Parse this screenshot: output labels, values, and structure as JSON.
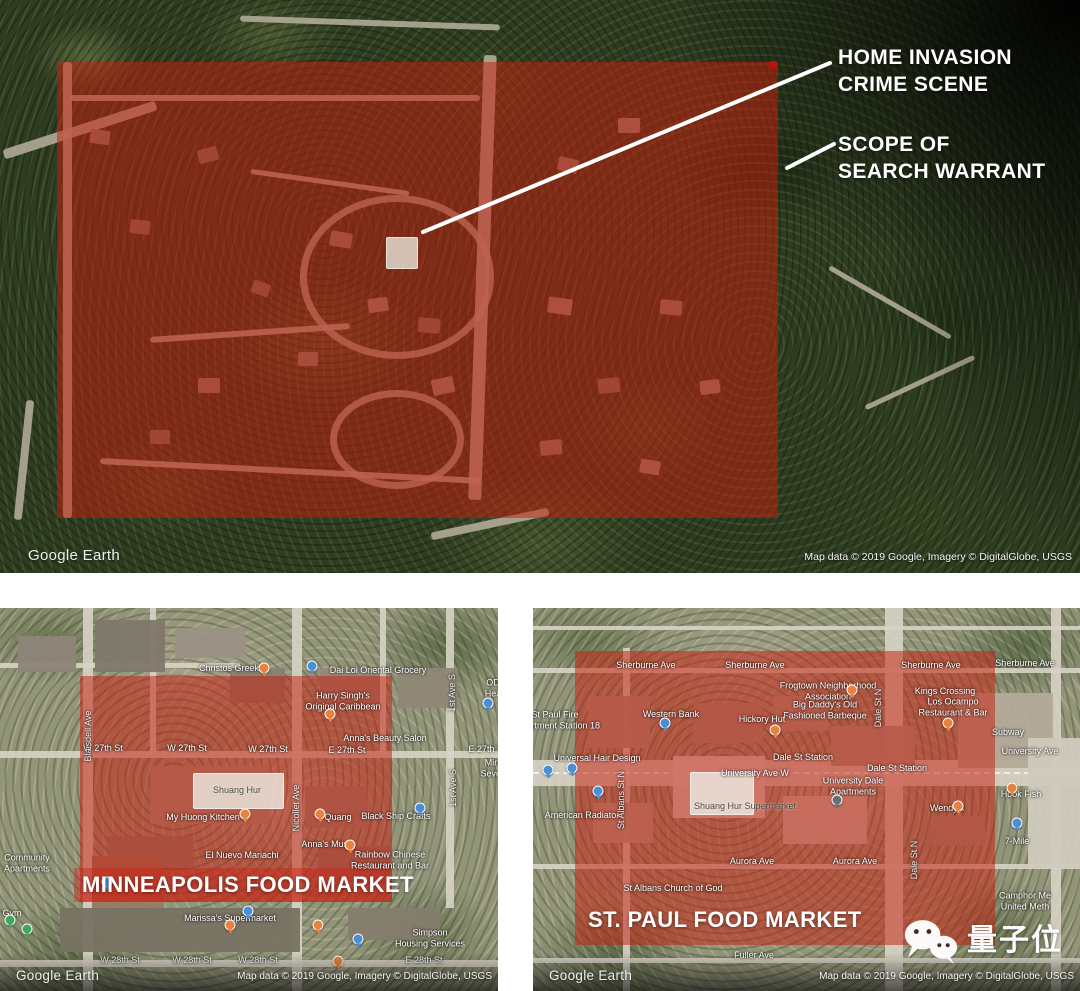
{
  "colors": {
    "overlay_red": "#c71e10",
    "callout_text": "#ffffff",
    "highlight_box": "#eeece4"
  },
  "top_map": {
    "callout1": "HOME INVASION\nCRIME SCENE",
    "callout2": "SCOPE OF\nSEARCH WARRANT",
    "logo": "Google Earth",
    "attribution": "Map data © 2019 Google, Imagery © DigitalGlobe, USGS"
  },
  "minneapolis_map": {
    "title": "MINNEAPOLIS FOOD MARKET",
    "logo": "Google Earth",
    "attribution": "Map data © 2019 Google, Imagery © DigitalGlobe, USGS",
    "highlight_label": "Shuang Hur",
    "labels": [
      {
        "t": "Christos Greek",
        "x": 229,
        "y": 60
      },
      {
        "t": "Dai Loi Oriental Grocery",
        "x": 378,
        "y": 62
      },
      {
        "t": "OD\nHea",
        "x": 493,
        "y": 80
      },
      {
        "t": "Harry Singh's\nOriginal Caribbean",
        "x": 343,
        "y": 93
      },
      {
        "t": "Anna's Beauty Salon",
        "x": 385,
        "y": 130
      },
      {
        "t": "W 27th St",
        "x": 103,
        "y": 140
      },
      {
        "t": "W 27th St",
        "x": 187,
        "y": 140
      },
      {
        "t": "W 27th St",
        "x": 268,
        "y": 141
      },
      {
        "t": "E 27th St",
        "x": 347,
        "y": 142
      },
      {
        "t": "E 27th St",
        "x": 487,
        "y": 141
      },
      {
        "t": "Minne\nSeventh",
        "x": 497,
        "y": 160
      },
      {
        "t": "Blaisdell Ave",
        "x": 88,
        "y": 128,
        "v": 1
      },
      {
        "t": "Nicollet Ave",
        "x": 296,
        "y": 200,
        "v": 1
      },
      {
        "t": "1st Ave S",
        "x": 452,
        "y": 85,
        "v": 1
      },
      {
        "t": "1st Ave S",
        "x": 453,
        "y": 180,
        "v": 1
      },
      {
        "t": "My Huong Kitchen",
        "x": 203,
        "y": 209
      },
      {
        "t": "Quang",
        "x": 338,
        "y": 209
      },
      {
        "t": "Black Ship Crafts",
        "x": 396,
        "y": 208
      },
      {
        "t": "Anna's Music",
        "x": 328,
        "y": 236
      },
      {
        "t": "El Nuevo Mariachi",
        "x": 242,
        "y": 247
      },
      {
        "t": "Rainbow Chinese\nRestaurant and Bar",
        "x": 390,
        "y": 252
      },
      {
        "t": "Community\nApartments",
        "x": 27,
        "y": 255
      },
      {
        "t": "Gym",
        "x": 12,
        "y": 305
      },
      {
        "t": "Marissa's Supermarket",
        "x": 230,
        "y": 310
      },
      {
        "t": "Simpson\nHousing Services",
        "x": 430,
        "y": 330
      },
      {
        "t": "W 28th St",
        "x": 120,
        "y": 352
      },
      {
        "t": "W 28th St",
        "x": 192,
        "y": 352
      },
      {
        "t": "W 28th St",
        "x": 258,
        "y": 352
      },
      {
        "t": "E 28th St",
        "x": 424,
        "y": 352
      }
    ],
    "pins": [
      {
        "x": 264,
        "y": 60,
        "c": "o"
      },
      {
        "x": 330,
        "y": 106,
        "c": "o"
      },
      {
        "x": 245,
        "y": 206,
        "c": "o"
      },
      {
        "x": 320,
        "y": 206,
        "c": "o"
      },
      {
        "x": 350,
        "y": 237,
        "c": "o"
      },
      {
        "x": 230,
        "y": 317,
        "c": "o"
      },
      {
        "x": 318,
        "y": 317,
        "c": "o"
      },
      {
        "x": 338,
        "y": 353,
        "c": "o"
      },
      {
        "x": 312,
        "y": 58,
        "c": "b"
      },
      {
        "x": 420,
        "y": 200,
        "c": "b"
      },
      {
        "x": 358,
        "y": 331,
        "c": "b"
      },
      {
        "x": 107,
        "y": 274,
        "c": "b"
      },
      {
        "x": 488,
        "y": 95,
        "c": "b"
      },
      {
        "x": 248,
        "y": 303,
        "c": "b"
      },
      {
        "x": 10,
        "y": 312,
        "c": "g"
      },
      {
        "x": 27,
        "y": 321,
        "c": "g"
      }
    ]
  },
  "stpaul_map": {
    "title": "ST. PAUL FOOD MARKET",
    "logo": "Google Earth",
    "attribution": "Map data © 2019 Google, Imagery © DigitalGlobe, USGS",
    "highlight_label": "Shuang Hur Supermarket",
    "labels": [
      {
        "t": "Sherburne Ave",
        "x": 113,
        "y": 57
      },
      {
        "t": "Sherburne Ave",
        "x": 222,
        "y": 57
      },
      {
        "t": "Sherburne Ave",
        "x": 398,
        "y": 57
      },
      {
        "t": "Sherburne Ave",
        "x": 492,
        "y": 55
      },
      {
        "t": "Frogtown Neighborhood\nAssociation",
        "x": 295,
        "y": 83
      },
      {
        "t": "Big Daddy's Old\nFashioned Barbeque",
        "x": 292,
        "y": 102
      },
      {
        "t": "Kings Crossing",
        "x": 412,
        "y": 83
      },
      {
        "t": "Los Ocampo\nRestaurant & Bar",
        "x": 420,
        "y": 99
      },
      {
        "t": "St Paul Fire\nDepartment Station 18",
        "x": 22,
        "y": 112
      },
      {
        "t": "Western Bank",
        "x": 138,
        "y": 106
      },
      {
        "t": "Hickory Hut",
        "x": 229,
        "y": 111
      },
      {
        "t": "Subway",
        "x": 475,
        "y": 124
      },
      {
        "t": "Universal Hair Design",
        "x": 64,
        "y": 150
      },
      {
        "t": "Dale St Station",
        "x": 270,
        "y": 149
      },
      {
        "t": "Dale St Station",
        "x": 364,
        "y": 160
      },
      {
        "t": "University Ave W",
        "x": 222,
        "y": 165
      },
      {
        "t": "University Ave",
        "x": 497,
        "y": 143
      },
      {
        "t": "University Dale\nApartments",
        "x": 320,
        "y": 178
      },
      {
        "t": "American Radiator",
        "x": 49,
        "y": 207
      },
      {
        "t": "Wendy's",
        "x": 414,
        "y": 200
      },
      {
        "t": "Hook Fish",
        "x": 488,
        "y": 186
      },
      {
        "t": "7-Mile",
        "x": 484,
        "y": 233
      },
      {
        "t": "Aurora Ave",
        "x": 219,
        "y": 253
      },
      {
        "t": "Aurora Ave",
        "x": 322,
        "y": 253
      },
      {
        "t": "St Albans Church of God",
        "x": 140,
        "y": 280
      },
      {
        "t": "Fuller Ave",
        "x": 221,
        "y": 347
      },
      {
        "t": "Camphor Me\nUnited Meth",
        "x": 492,
        "y": 293
      },
      {
        "t": "Dale St N",
        "x": 345,
        "y": 100,
        "v": 1
      },
      {
        "t": "St Albans St N",
        "x": 88,
        "y": 192,
        "v": 1
      },
      {
        "t": "Dale St N",
        "x": 381,
        "y": 252,
        "v": 1
      }
    ],
    "pins": [
      {
        "x": 319,
        "y": 82,
        "c": "o"
      },
      {
        "x": 242,
        "y": 122,
        "c": "o"
      },
      {
        "x": 415,
        "y": 115,
        "c": "o"
      },
      {
        "x": 425,
        "y": 198,
        "c": "o"
      },
      {
        "x": 479,
        "y": 180,
        "c": "o"
      },
      {
        "x": 15,
        "y": 162,
        "c": "b"
      },
      {
        "x": 39,
        "y": 160,
        "c": "b"
      },
      {
        "x": 132,
        "y": 115,
        "c": "b"
      },
      {
        "x": 484,
        "y": 215,
        "c": "b"
      },
      {
        "x": 65,
        "y": 183,
        "c": "b"
      },
      {
        "x": 304,
        "y": 192,
        "c": "d"
      }
    ]
  },
  "watermark": {
    "icon": "wechat-icon",
    "text": "量子位"
  }
}
